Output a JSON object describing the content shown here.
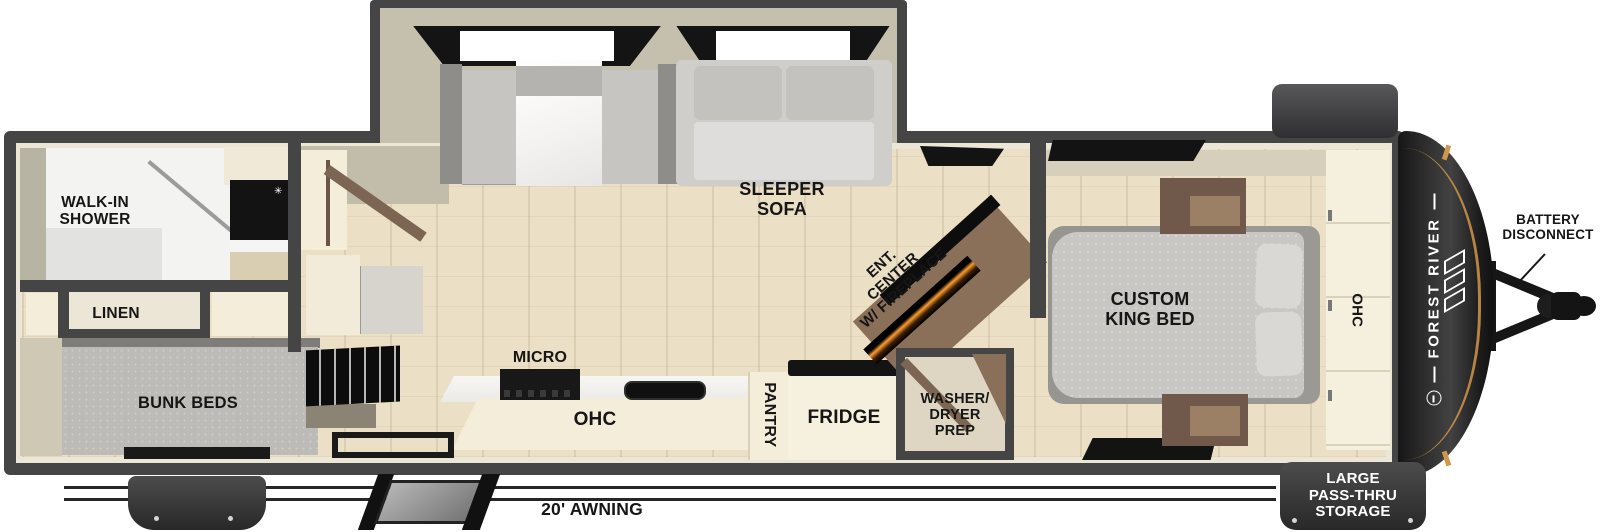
{
  "meta": {
    "type": "rv-floorplan-diagram"
  },
  "brand": {
    "name": "FOREST RIVER"
  },
  "colors": {
    "wall": "#454545",
    "lining": "#ece6d6",
    "floor_wood": "#ebdfc5",
    "wall_tan": "#c5c0ad",
    "cabinet_cream": "#f4edda",
    "cushion_gray": "#c6c5c1",
    "bench_back_gray": "#8e8d89",
    "mattress_gray": "#c8c7c3",
    "bunk_gray": "#bcbbb7",
    "wood_brown": "#8a7058",
    "appliance_black": "#141414",
    "cap_black": "#1d1d1d",
    "accent_amber": "#d2964a",
    "label_dark": "#161616",
    "text_white": "#ffffff"
  },
  "icons": {
    "faucet": "✳"
  },
  "labels": {
    "walk_in_shower": "WALK-IN\nSHOWER",
    "linen": "LINEN",
    "bunk_beds": "BUNK BEDS",
    "sleeper_sofa": "SLEEPER\nSOFA",
    "ent_center": "ENT.\nCENTER\nW/ FIREPLACE",
    "micro": "MICRO",
    "kitchen_ohc": "OHC",
    "pantry": "PANTRY",
    "fridge": "FRIDGE",
    "washer_dryer_prep": "WASHER/\nDRYER\nPREP",
    "custom_king_bed": "CUSTOM\nKING BED",
    "bedroom_ohc": "OHC",
    "battery_disconnect": "BATTERY\nDISCONNECT",
    "pass_thru_storage": "LARGE\nPASS-THRU\nSTORAGE",
    "awning": "20' AWNING"
  }
}
